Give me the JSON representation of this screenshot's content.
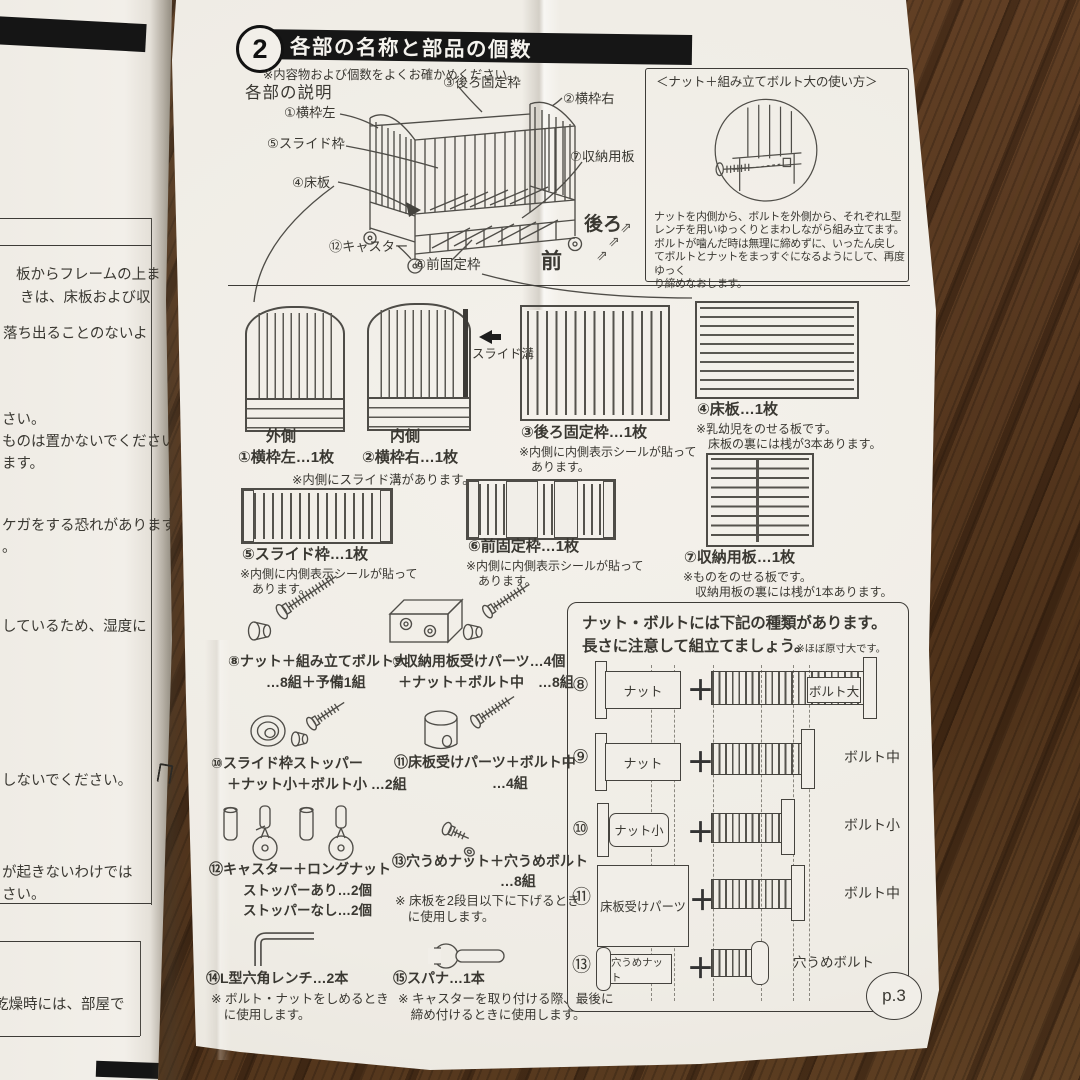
{
  "header": {
    "num": "2",
    "title": "各部の名称と部品の個数",
    "check_note": "※内容物および個数をよくお確かめください。",
    "desc_title": "各部の説明"
  },
  "crib": {
    "labels": {
      "p1": "①横枠左",
      "p2": "②横枠右",
      "p3": "③後ろ固定枠",
      "p4": "④床板",
      "p5": "⑤スライド枠",
      "p6": "⑥前固定枠",
      "p7": "⑦収納用板",
      "p12": "⑫キャスター"
    },
    "back": "後ろ",
    "front": "前"
  },
  "usage_box": {
    "title": "＜ナット＋組み立てボルト大の使い方＞",
    "body": "ナットを内側から、ボルトを外側から、それぞれL型\nレンチを用いゆっくりとまわしながら組み立てます。\nボルトが噛んだ時は無理に締めずに、いったん戻し\nてボルトとナットをまっすぐになるようにして、再度ゆっく\nり締めなおします。"
  },
  "parts": {
    "p1": {
      "side": "外側",
      "label": "①横枠左…1枚"
    },
    "p2": {
      "side": "内側",
      "label": "②横枠右…1枚"
    },
    "note12": "※内側にスライド溝があります。",
    "groove": "スライド溝",
    "p3": {
      "label": "③後ろ固定枠…1枚",
      "note": "※内側に内側表示シールが貼って\n　あります。"
    },
    "p4": {
      "label": "④床板…1枚",
      "note": "※乳幼児をのせる板です。\n　床板の裏には桟が3本あります。"
    },
    "p5": {
      "label": "⑤スライド枠…1枚",
      "note": "※内側に内側表示シールが貼って\n　あります。"
    },
    "p6": {
      "label": "⑥前固定枠…1枚",
      "note": "※内側に内側表示シールが貼って\n　あります。"
    },
    "p7": {
      "label": "⑦収納用板…1枚",
      "note": "※ものをのせる板です。\n　収納用板の裏には桟が1本あります。"
    }
  },
  "hardware": {
    "h8": {
      "label": "⑧ナット＋組み立てボルト大",
      "sub": "…8組＋予備1組"
    },
    "h9": {
      "label": "⑨収納用板受けパーツ…4個",
      "sub": "＋ナット＋ボルト中　…8組"
    },
    "h10": {
      "label": "⑩スライド枠ストッパー",
      "sub": "＋ナット小＋ボルト小 …2組"
    },
    "h11": {
      "label": "⑪床板受けパーツ＋ボルト中",
      "sub": "…4組"
    },
    "h12": {
      "label": "⑫キャスター＋ロングナット",
      "sub": "ストッパーあり…2個",
      "sub2": "ストッパーなし…2個"
    },
    "h13": {
      "label": "⑬穴うめナット＋穴うめボルト",
      "sub": "…8組",
      "note": "※ 床板を2段目以下に下げるとき\n　に使用します。"
    },
    "h14": {
      "label": "⑭L型六角レンチ…2本",
      "note": "※ ボルト・ナットをしめるとき\n　に使用します。"
    },
    "h15": {
      "label": "⑮スパナ…1本",
      "note": "※ キャスターを取り付ける際、最後に\n　締め付けるときに使用します。"
    }
  },
  "bolt_table": {
    "title1": "ナット・ボルトには下記の種類があります。",
    "title2": "長さに注意して組立てましょう。",
    "scale_note": "※ほぼ原寸大です。",
    "rows": {
      "r8": {
        "num": "⑧",
        "left": "ナット",
        "right": "ボルト大"
      },
      "r9": {
        "num": "⑨",
        "left": "ナット",
        "right": "ボルト中"
      },
      "r10": {
        "num": "⑩",
        "left": "ナット小",
        "right": "ボルト小"
      },
      "r11": {
        "num": "⑪",
        "left": "床板受けパーツ",
        "right": "ボルト中"
      },
      "r13": {
        "num": "⑬",
        "left": "穴うめナット",
        "right": "穴うめボルト"
      }
    },
    "page_num": "p.3"
  },
  "left_page": {
    "lines": [
      "板からフレームの上ま",
      "きは、床板および収",
      "落ち出ることのないよ",
      "さい。",
      "ものは置かないでください。",
      "ます。",
      "ケガをする恐れがあります。",
      "。",
      "しているため、湿度に",
      "しないでください。",
      "が起きないわけでは",
      "さい。",
      "乾燥時には、部屋で"
    ]
  }
}
